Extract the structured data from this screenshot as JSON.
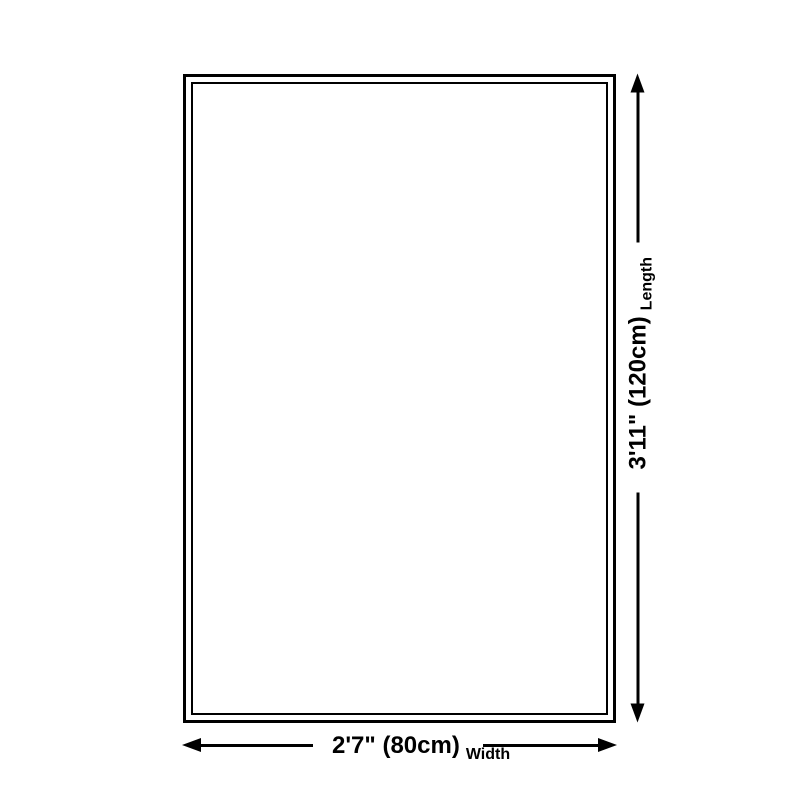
{
  "diagram": {
    "background_color": "#ffffff",
    "line_color": "#000000",
    "width": {
      "value": "2'7\" (80cm)",
      "label": "Width"
    },
    "length": {
      "value": "3'11\" (120cm)",
      "label": "Length"
    }
  }
}
